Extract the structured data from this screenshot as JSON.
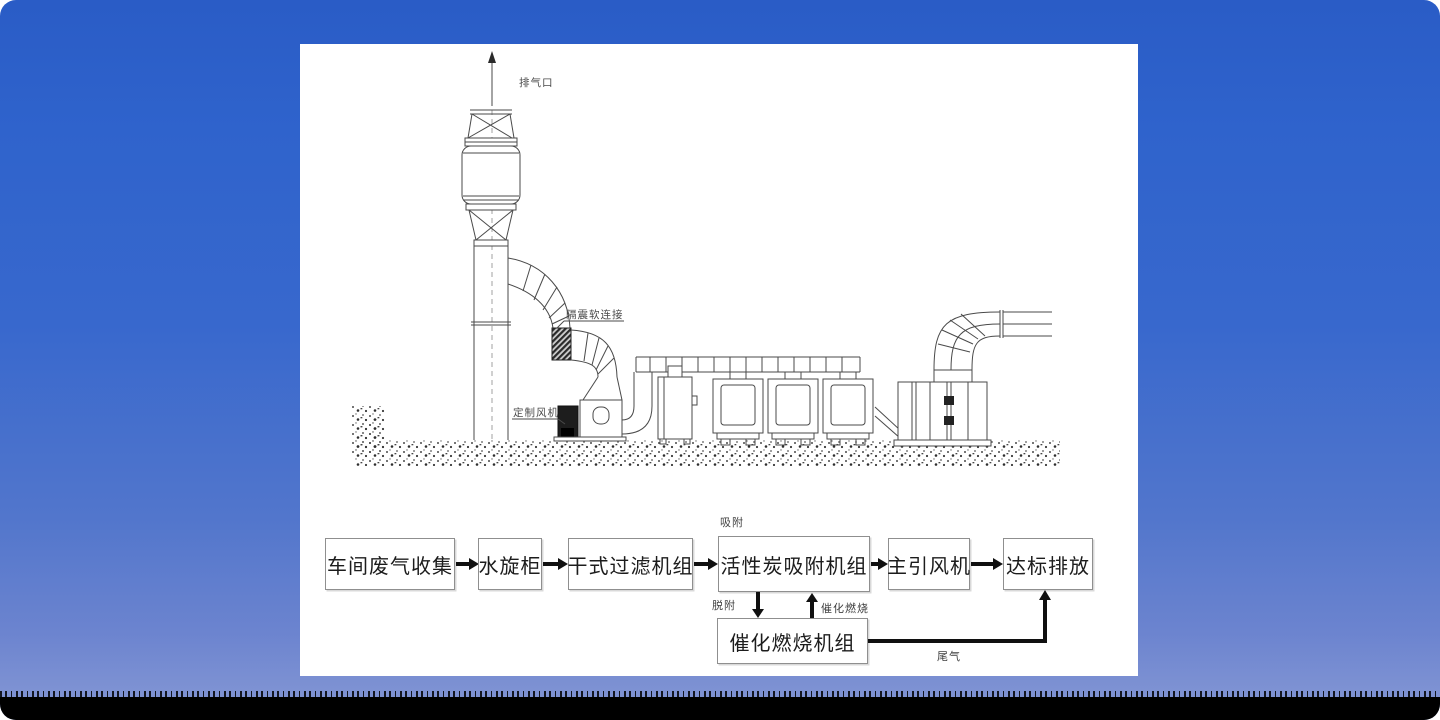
{
  "colors": {
    "background_top": "#2a5cc6",
    "background_bottom": "#7e92d3",
    "footer_bar": "#000000",
    "panel": "#ffffff",
    "line_art": "#4a4a4a",
    "flow_arrow": "#101010",
    "box_border": "#8f8f8f"
  },
  "equipment_diagram": {
    "labels": {
      "exhaust_outlet": "排气口",
      "vibration_isolator": "隔震软连接",
      "custom_fan": "定制风机"
    }
  },
  "flowchart": {
    "boxes": [
      {
        "label": "车间废气收集"
      },
      {
        "label": "水旋柜"
      },
      {
        "label": "干式过滤机组"
      },
      {
        "label": "活性炭吸附机组"
      },
      {
        "label": "主引风机"
      },
      {
        "label": "达标排放"
      }
    ],
    "catalytic_box": {
      "label": "催化燃烧机组"
    },
    "annotations": {
      "adsorption": "吸附",
      "desorption": "脱附",
      "catalytic_combustion": "催化燃烧",
      "tail_gas": "尾气"
    }
  }
}
